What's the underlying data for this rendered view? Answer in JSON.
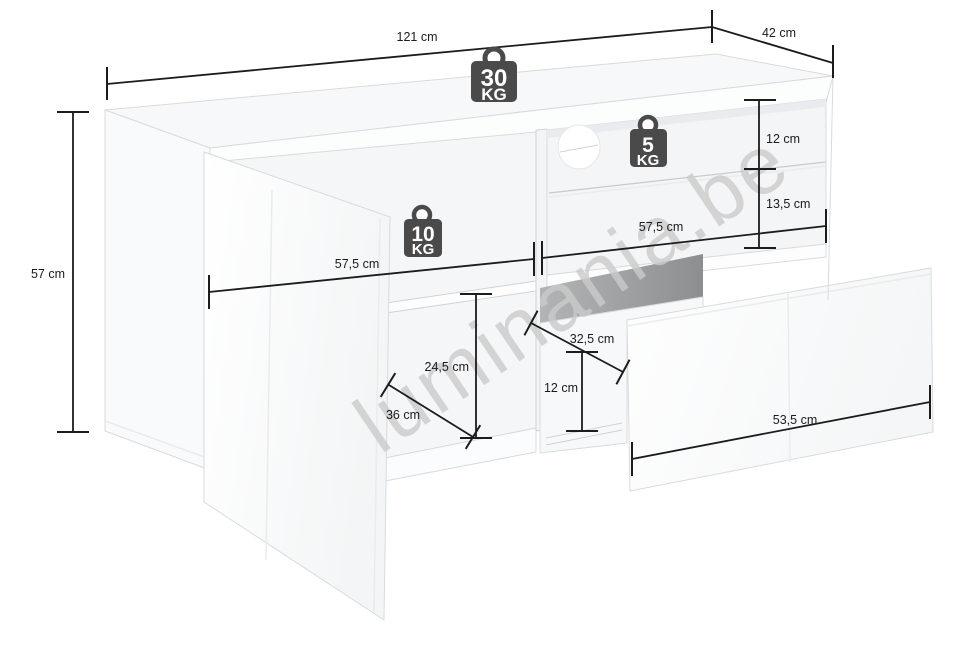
{
  "watermark": "luminania.be",
  "dimensions": {
    "overall_width": "121 cm",
    "overall_depth": "42 cm",
    "overall_height": "57 cm",
    "left_interior_width": "57,5 cm",
    "right_interior_width": "57,5 cm",
    "glass_shelf_clearance": "12 cm",
    "below_glass_clearance": "13,5 cm",
    "left_compartment_height": "24,5 cm",
    "left_compartment_depth": "36 cm",
    "drawer_interior_depth": "32,5 cm",
    "drawer_interior_height": "12 cm",
    "drawer_front_width": "53,5 cm"
  },
  "load_capacity": {
    "top_panel": {
      "value": "30",
      "unit": "KG"
    },
    "middle_shelf": {
      "value": "10",
      "unit": "KG"
    },
    "glass_shelf": {
      "value": "5",
      "unit": "KG"
    }
  },
  "colors": {
    "dimension_line": "#1c1c1c",
    "weight_icon": "#4a4a4a",
    "edge_line": "#d8dbdd",
    "cavity_shadow": "#979a9b",
    "watermark": "#cbcbcb"
  }
}
